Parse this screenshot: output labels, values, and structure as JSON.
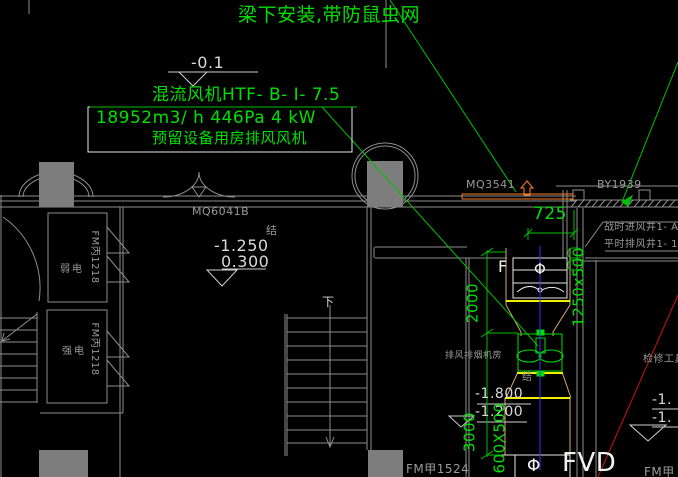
{
  "palette": {
    "bg": "#000000",
    "annotation_green": "#00e000",
    "line_green": "#00c000",
    "wall_gray": "#8e8e8e",
    "text_gray": "#9a9a9a",
    "elevation_light": "#d9d9d9",
    "symbol_white": "#f2f2f2",
    "window_orange": "#ff7f27",
    "duct_tan": "#d8a878",
    "flange_yellow": "#f0f000",
    "centerline_blue": "#3333ff",
    "leader_red": "#cc1111",
    "column_fill": "#7d7d7d"
  },
  "notes": {
    "roof_note": "梁下安装,带防鼠虫网"
  },
  "fan_block": {
    "title": "混流风机HTF- B- I- 7.5",
    "spec": "18952m3/ h 446Pa 4 kW",
    "note": "预留设备用房排风风机"
  },
  "elevations": {
    "top": "-0.1",
    "mid_upper": "-1.250",
    "mid_lower": "0.300",
    "shaft_upper": "-1.800",
    "shaft_lower": "-1.200",
    "right_upper": "-1.",
    "right_lower": "-1."
  },
  "dimensions": {
    "d725": "725",
    "d2000": "2000",
    "d3000": "3000",
    "duct_upper": "1250x500",
    "duct_lower": "600X500"
  },
  "labels": {
    "mq6041b": "MQ6041B",
    "mq3541": "MQ3541",
    "by1939": "BY1939",
    "war_shaft": "战时进风井1- A",
    "peace_shaft": "平时排风井1- 1",
    "fan_room": "排风排烟机房",
    "tool_room": "检修工具间",
    "weak_power": "弱电",
    "strong_power": "强电",
    "fm_c1218": "FM丙1218",
    "fm_a1524": "FM甲1524",
    "fm_corner": "FM甲",
    "fvd": "FVD",
    "f": "F",
    "phi": "Φ",
    "jie": "结",
    "down": "下"
  }
}
